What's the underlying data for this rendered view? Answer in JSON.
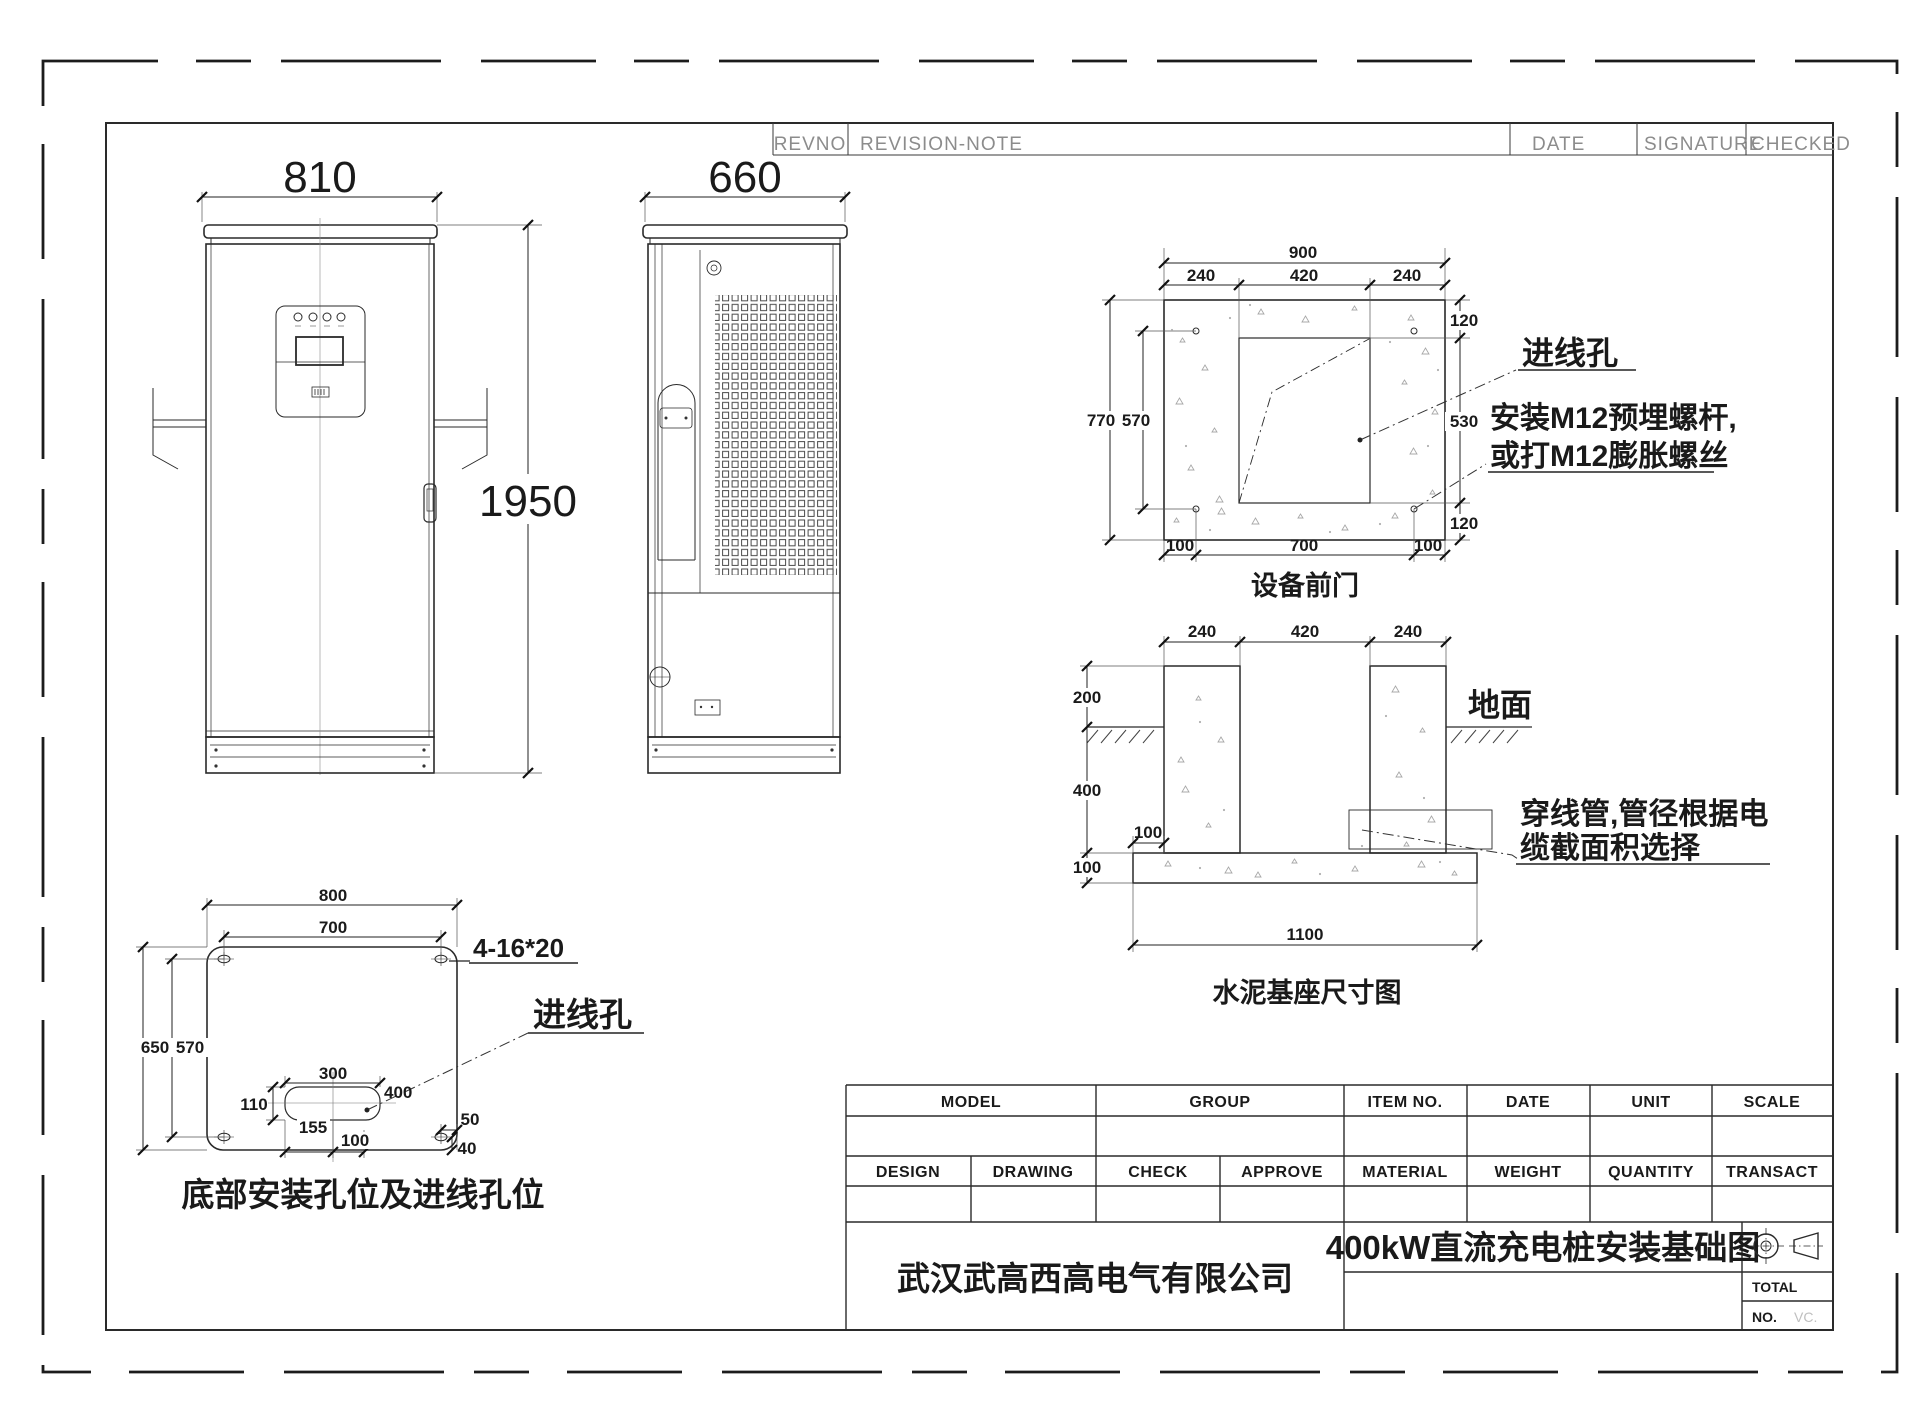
{
  "revision_header": {
    "revno": "REVNO",
    "revision_note": "REVISION-NOTE",
    "date": "DATE",
    "signature": "SIGNATURE",
    "checked": "CHECKED"
  },
  "front_view": {
    "width": "810",
    "height": "1950"
  },
  "side_view": {
    "width": "660"
  },
  "plan_view": {
    "caption": "设备前门",
    "overall_width": "900",
    "margin_left": "240",
    "opening_width": "420",
    "margin_right": "240",
    "margin_top": "120",
    "opening_height": "530",
    "margin_bottom": "120",
    "overall_height": "770",
    "bolt_span_v": "570",
    "edge_left": "100",
    "bolt_span_h": "700",
    "edge_right": "100",
    "cable_hole_label": "进线孔",
    "bolt_note_line1": "安装M12预埋螺杆,",
    "bolt_note_line2": "或打M12膨胀螺丝"
  },
  "section_view": {
    "caption": "水泥基座尺寸图",
    "pier_left": "240",
    "pier_gap": "420",
    "pier_right": "240",
    "above_ground": "200",
    "below_ground": "400",
    "slab_edge": "100",
    "slab_thickness": "100",
    "slab_width": "1100",
    "ground_label": "地面",
    "conduit_note_line1": "穿线管,管径根据电",
    "conduit_note_line2": "缆截面积选择"
  },
  "bottom_view": {
    "caption": "底部安装孔位及进线孔位",
    "overall_width": "800",
    "hole_span_h": "700",
    "overall_height": "650",
    "hole_span_v": "570",
    "slot_width": "300",
    "slot_label": "400",
    "slot_height": "110",
    "offset_a": "155",
    "offset_b": "100",
    "offset_c": "50",
    "offset_d": "40",
    "holes_note": "4-16*20",
    "cable_hole_label": "进线孔"
  },
  "title_block": {
    "model": "MODEL",
    "group": "GROUP",
    "item_no": "ITEM NO.",
    "date": "DATE",
    "unit": "UNIT",
    "scale": "SCALE",
    "design": "DESIGN",
    "drawing": "DRAWING",
    "check": "CHECK",
    "approve": "APPROVE",
    "material": "MATERIAL",
    "weight": "WEIGHT",
    "quantity": "QUANTITY",
    "transact": "TRANSACT",
    "company": "武汉武高西高电气有限公司",
    "drawing_title": "400kW直流充电桩安装基础图",
    "total": "TOTAL",
    "no": "NO.",
    "no_value": "VC."
  }
}
